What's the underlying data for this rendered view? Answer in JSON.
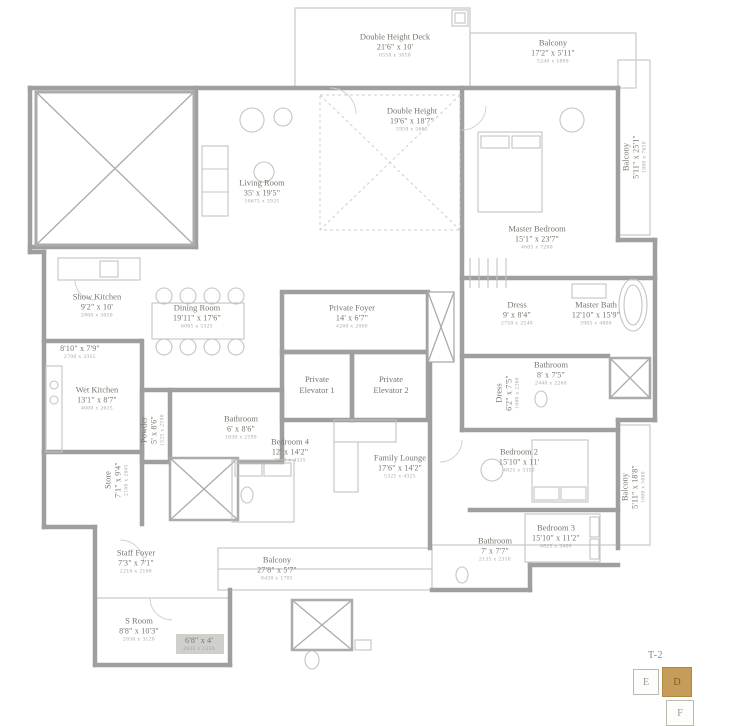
{
  "plan": {
    "colors": {
      "wall": "#9f9f9f",
      "thin_line": "#c9c9c9",
      "label_text": "#77766e",
      "metric_text": "#a4a39a",
      "keyplan_active": "#c79b59"
    },
    "rooms": [
      {
        "id": "double-height-deck",
        "name": "Double Height Deck",
        "dims": "21'6\" x 10'",
        "metric": "6550 x 3050",
        "x": 395,
        "y": 46,
        "rot": 0
      },
      {
        "id": "balcony-top",
        "name": "Balcony",
        "dims": "17'2\" x 5'11\"",
        "metric": "5240 x 1800",
        "x": 553,
        "y": 52,
        "rot": 0
      },
      {
        "id": "balcony-right-upper",
        "name": "Balcony",
        "dims": "5'11\" x 25'1\"",
        "metric": "1800 x 7650",
        "x": 635,
        "y": 157,
        "rot": -90
      },
      {
        "id": "double-height",
        "name": "Double Height",
        "dims": "19'6\" x 18'7\"",
        "metric": "5950 x 5665",
        "x": 412,
        "y": 120,
        "rot": 0
      },
      {
        "id": "living-room",
        "name": "Living Room",
        "dims": "35' x 19'5\"",
        "metric": "10675 x 5925",
        "x": 262,
        "y": 192,
        "rot": 0
      },
      {
        "id": "master-bedroom",
        "name": "Master Bedroom",
        "dims": "15'1\" x 23'7\"",
        "metric": "4605 x 7200",
        "x": 537,
        "y": 238,
        "rot": 0
      },
      {
        "id": "show-kitchen",
        "name": "Show Kitchen",
        "dims": "9'2\" x 10'",
        "metric": "2800 x 3050",
        "x": 97,
        "y": 306,
        "rot": 0
      },
      {
        "id": "dining-room",
        "name": "Dining Room",
        "dims": "19'11\" x 17'6\"",
        "metric": "6065 x 5325",
        "x": 197,
        "y": 317,
        "rot": 0
      },
      {
        "id": "private-foyer",
        "name": "Private Foyer",
        "dims": "14' x 6'7\"",
        "metric": "4260 x 2000",
        "x": 352,
        "y": 317,
        "rot": 0
      },
      {
        "id": "dress-master",
        "name": "Dress",
        "dims": "9' x 8'4\"",
        "metric": "2750 x 2540",
        "x": 517,
        "y": 314,
        "rot": 0
      },
      {
        "id": "master-bath",
        "name": "Master Bath",
        "dims": "12'10\" x 15'9\"",
        "metric": "3905 x 4800",
        "x": 596,
        "y": 314,
        "rot": 0
      },
      {
        "id": "store-upper",
        "name": "",
        "dims": "8'10\" x 7'9\"",
        "metric": "2700 x 2355",
        "x": 80,
        "y": 353,
        "rot": 0
      },
      {
        "id": "wet-kitchen",
        "name": "Wet Kitchen",
        "dims": "13'1\" x 8'7\"",
        "metric": "4000 x 2615",
        "x": 97,
        "y": 399,
        "rot": 0
      },
      {
        "id": "private-elevator-1",
        "name": "Private Elevator 1",
        "dims": "",
        "metric": "",
        "x": 317,
        "y": 385,
        "rot": 0,
        "wrap": true
      },
      {
        "id": "private-elevator-2",
        "name": "Private Elevator 2",
        "dims": "",
        "metric": "",
        "x": 391,
        "y": 385,
        "rot": 0,
        "wrap": true
      },
      {
        "id": "powder",
        "name": "Powder",
        "dims": "5' x 8'6\"",
        "metric": "1525 x 2590",
        "x": 153,
        "y": 430,
        "rot": -90
      },
      {
        "id": "bathroom-4",
        "name": "Bathroom",
        "dims": "6' x 8'6\"",
        "metric": "1830 x 2590",
        "x": 241,
        "y": 428,
        "rot": 0
      },
      {
        "id": "bedroom-4",
        "name": "Bedroom 4",
        "dims": "12' x 14'2\"",
        "metric": "3660 x 4325",
        "x": 290,
        "y": 451,
        "rot": 0
      },
      {
        "id": "family-lounge",
        "name": "Family Lounge",
        "dims": "17'6\" x 14'2\"",
        "metric": "5325 x 4325",
        "x": 400,
        "y": 467,
        "rot": 0
      },
      {
        "id": "dress-2",
        "name": "Dress",
        "dims": "6'2\" x 7'5\"",
        "metric": "1880 x 2260",
        "x": 508,
        "y": 393,
        "rot": -90
      },
      {
        "id": "bathroom-2",
        "name": "Bathroom",
        "dims": "8' x 7'5\"",
        "metric": "2440 x 2260",
        "x": 551,
        "y": 374,
        "rot": 0
      },
      {
        "id": "bedroom-2",
        "name": "Bedroom 2",
        "dims": "15'10\" x 11'",
        "metric": "4825 x 3350",
        "x": 519,
        "y": 461,
        "rot": 0
      },
      {
        "id": "balcony-right-lower",
        "name": "Balcony",
        "dims": "5'11\" x 18'8\"",
        "metric": "1800 x 5680",
        "x": 634,
        "y": 487,
        "rot": -90
      },
      {
        "id": "bedroom-3",
        "name": "Bedroom 3",
        "dims": "15'10\" x 11'2\"",
        "metric": "4825 x 3400",
        "x": 556,
        "y": 537,
        "rot": 0
      },
      {
        "id": "bathroom-3",
        "name": "Bathroom",
        "dims": "7' x 7'7\"",
        "metric": "2135 x 2310",
        "x": 495,
        "y": 550,
        "rot": 0
      },
      {
        "id": "store",
        "name": "Store",
        "dims": "7'1\" x 9'4\"",
        "metric": "2160 x 2845",
        "x": 117,
        "y": 480,
        "rot": -90
      },
      {
        "id": "staff-foyer",
        "name": "Staff Foyer",
        "dims": "7'3\" x 7'1\"",
        "metric": "2210 x 2160",
        "x": 136,
        "y": 562,
        "rot": 0
      },
      {
        "id": "balcony-bottom",
        "name": "Balcony",
        "dims": "27'8\" x 5'7\"",
        "metric": "8430 x 1705",
        "x": 277,
        "y": 569,
        "rot": 0
      },
      {
        "id": "s-room",
        "name": "S Room",
        "dims": "8'8\" x 10'3\"",
        "metric": "2630 x 3120",
        "x": 139,
        "y": 630,
        "rot": 0
      },
      {
        "id": "store-small",
        "name": "",
        "dims": "6'8\" x 4'",
        "metric": "2035 x 1220",
        "x": 199,
        "y": 645,
        "rot": 0
      }
    ],
    "keyplan": {
      "title": "T-2",
      "cells": [
        {
          "label": "E",
          "active": false,
          "x": 633,
          "y": 669,
          "w": 26,
          "h": 26
        },
        {
          "label": "D",
          "active": true,
          "x": 662,
          "y": 667,
          "w": 30,
          "h": 30
        },
        {
          "label": "F",
          "active": false,
          "x": 666,
          "y": 700,
          "w": 28,
          "h": 26
        }
      ]
    }
  }
}
